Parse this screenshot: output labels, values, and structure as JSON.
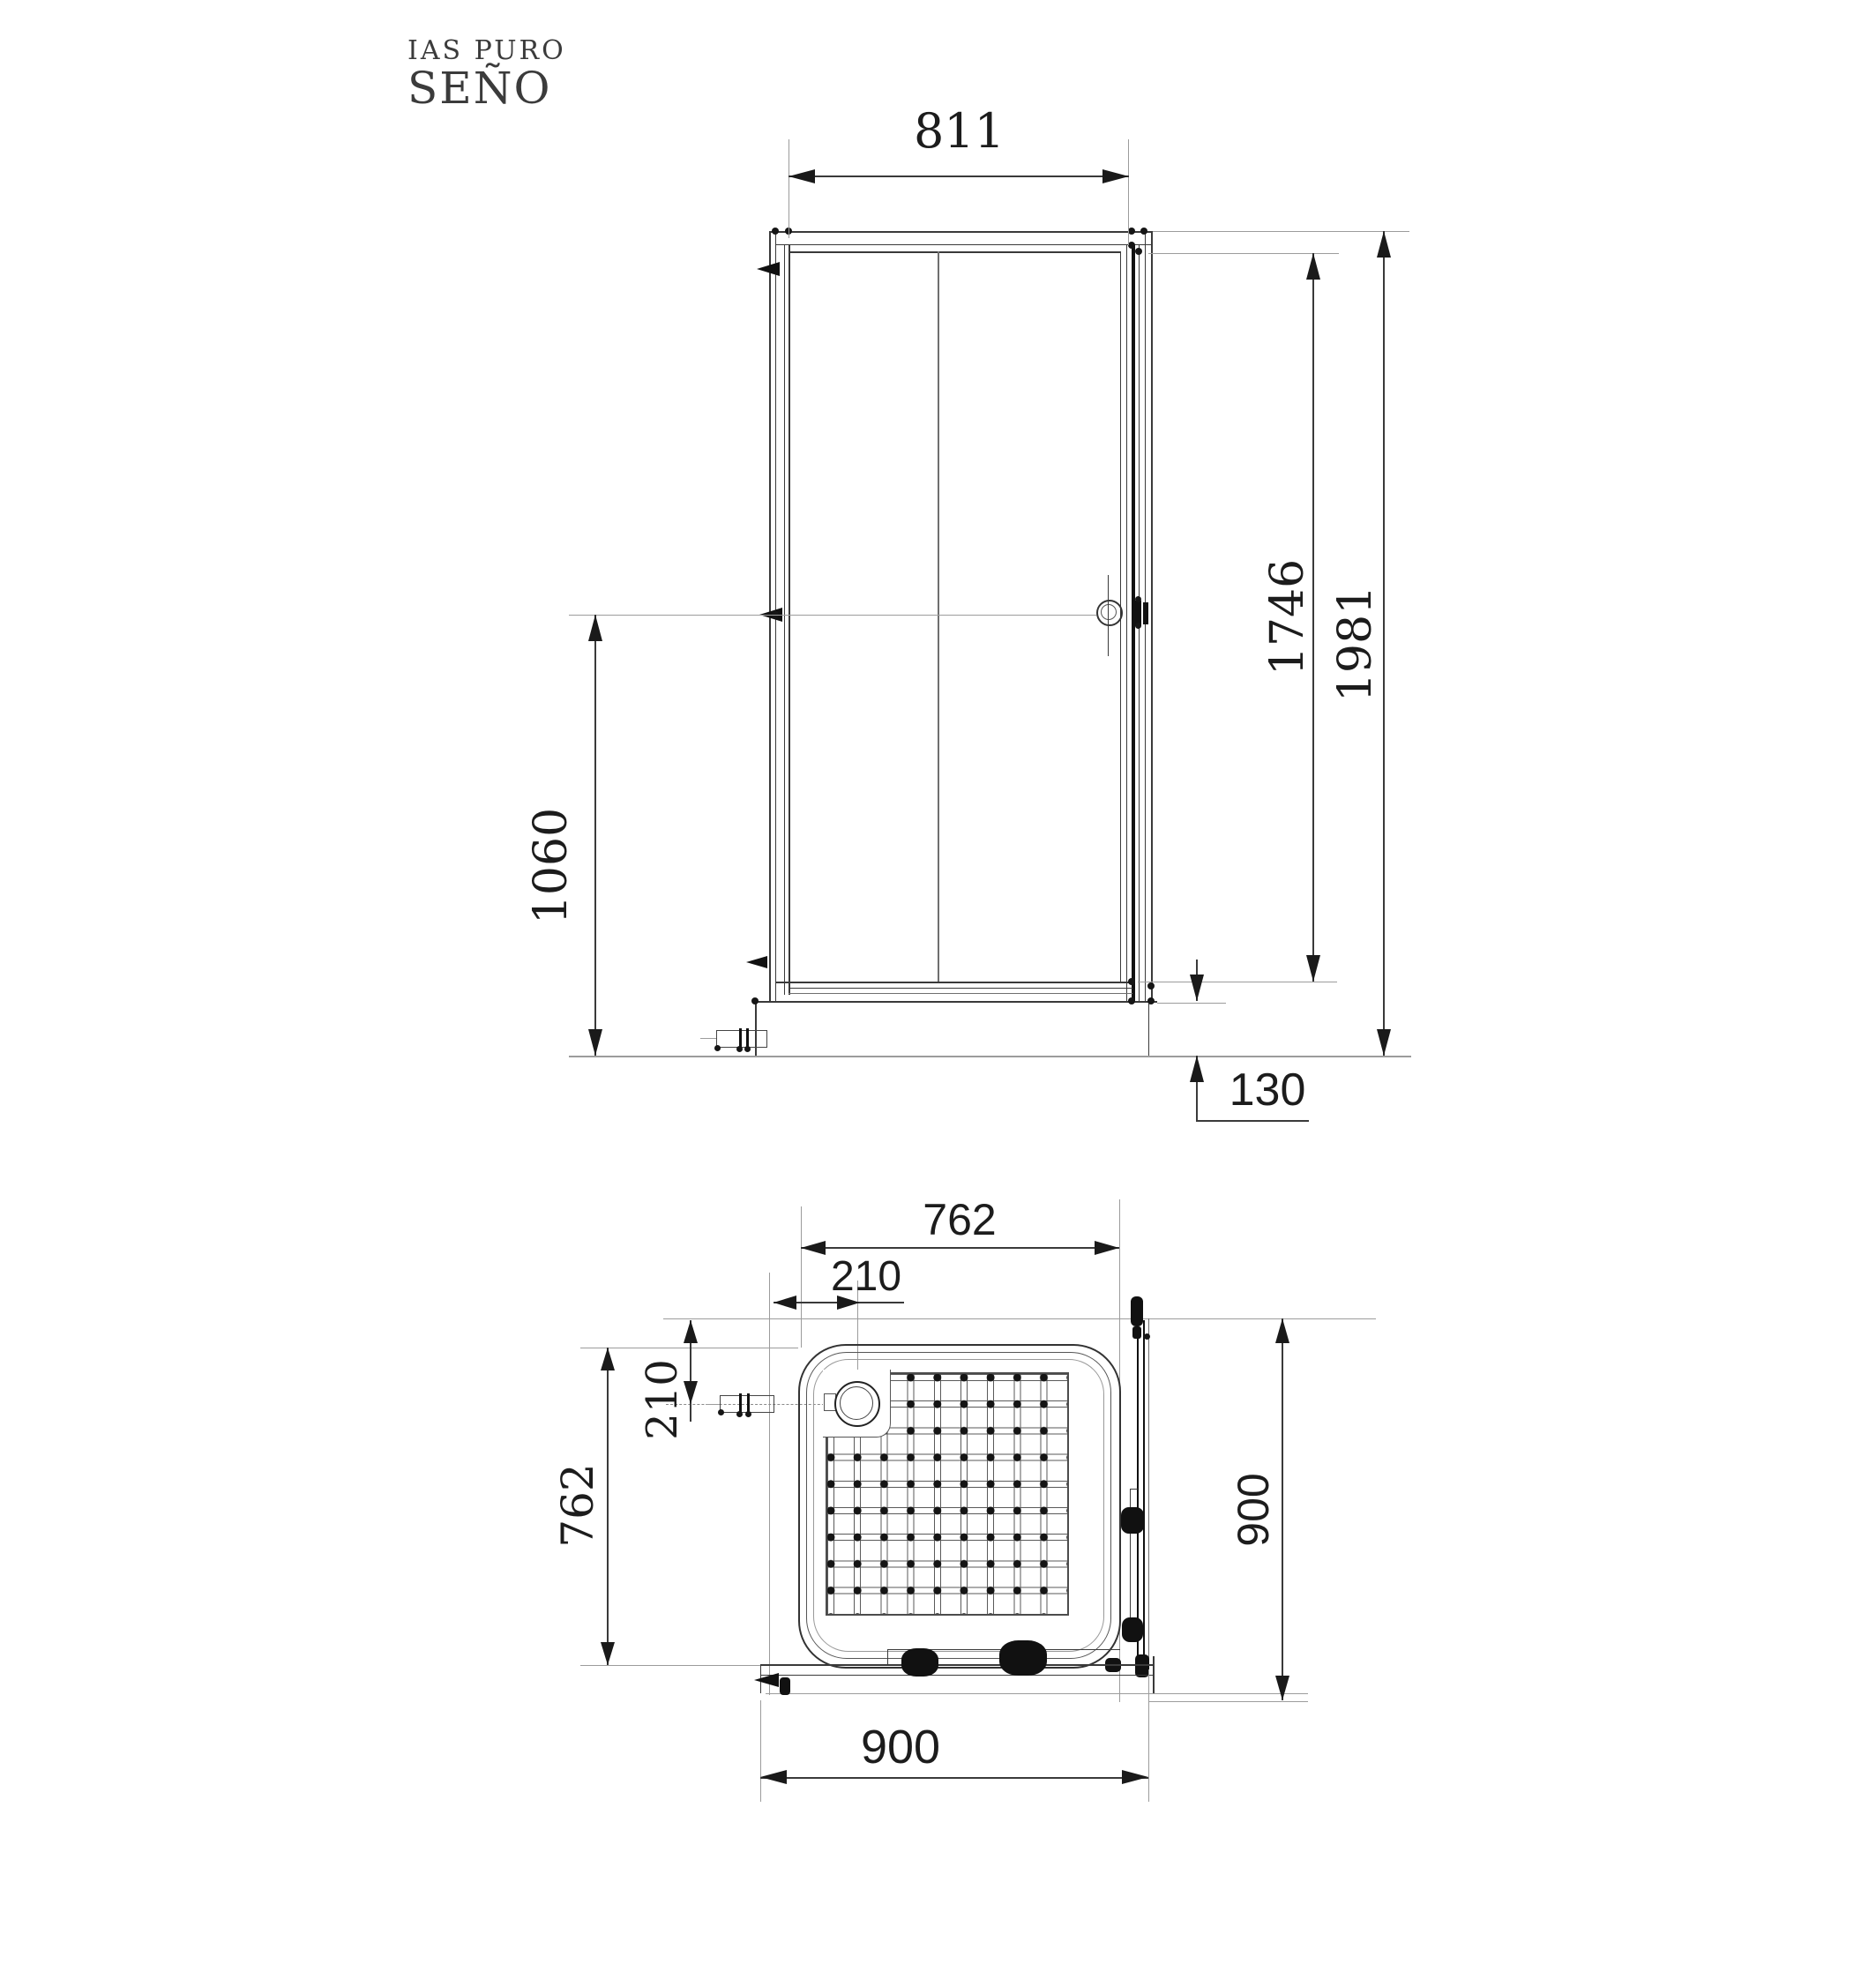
{
  "document": {
    "type": "shower enclosure technical drawing",
    "views": [
      "front elevation",
      "plan view"
    ]
  },
  "logo": {
    "line1": "IAS PURO",
    "line2": "SEÑO"
  },
  "front_view": {
    "dims": {
      "door_width": "811",
      "glass_height": "1746",
      "total_height": "1981",
      "handle_height": "1060",
      "tray_height": "130"
    }
  },
  "plan_view": {
    "dims": {
      "tray_width": "762",
      "drain_offset_x": "210",
      "drain_offset_y": "210",
      "tray_depth": "762",
      "enclosure_depth": "900",
      "enclosure_width": "900"
    }
  },
  "colors": {
    "line_dark": "#3a3a3a",
    "line_black": "#111111",
    "line_gray": "#9c9c9c",
    "paper": "#ffffff",
    "text": "#1c1c1c"
  }
}
